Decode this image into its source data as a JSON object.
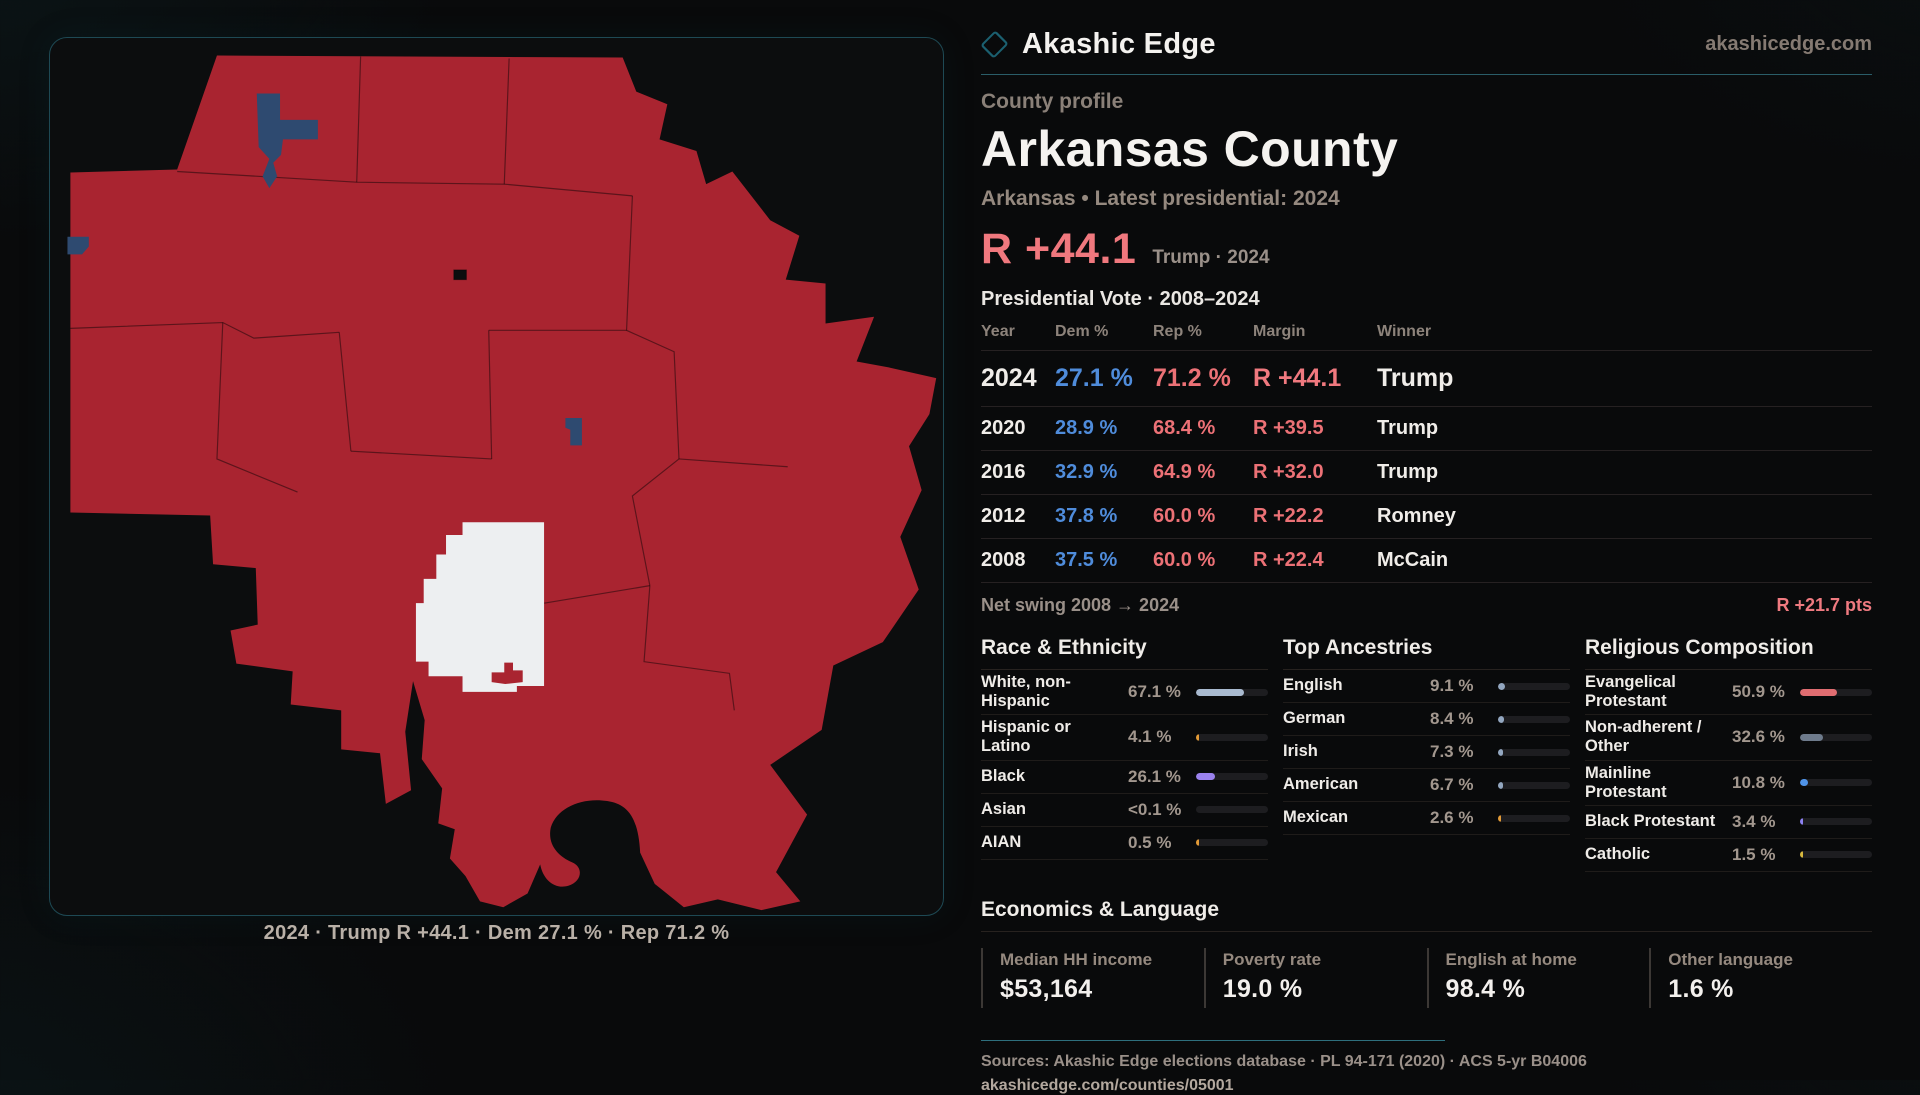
{
  "brand": {
    "name": "Akashic Edge",
    "domain": "akashicedge.com"
  },
  "profile": {
    "eyebrow": "County profile",
    "title": "Arkansas County",
    "subtitle": "Arkansas • Latest presidential: 2024",
    "margin_value": "R +44.1",
    "margin_caption": "Trump · 2024"
  },
  "map": {
    "caption": "2024 · Trump R +44.1 · Dem 27.1 % · Rep 71.2 %"
  },
  "vote_table": {
    "title": "Presidential Vote · 2008–2024",
    "columns": {
      "year": "Year",
      "dem": "Dem %",
      "rep": "Rep %",
      "margin": "Margin",
      "winner": "Winner"
    },
    "rows": [
      {
        "year": "2024",
        "dem": "27.1 %",
        "rep": "71.2 %",
        "margin": "R +44.1",
        "winner": "Trump"
      },
      {
        "year": "2020",
        "dem": "28.9 %",
        "rep": "68.4 %",
        "margin": "R +39.5",
        "winner": "Trump"
      },
      {
        "year": "2016",
        "dem": "32.9 %",
        "rep": "64.9 %",
        "margin": "R +32.0",
        "winner": "Trump"
      },
      {
        "year": "2012",
        "dem": "37.8 %",
        "rep": "60.0 %",
        "margin": "R +22.2",
        "winner": "Romney"
      },
      {
        "year": "2008",
        "dem": "37.5 %",
        "rep": "60.0 %",
        "margin": "R +22.4",
        "winner": "McCain"
      }
    ],
    "net_swing_label": "Net swing 2008 → 2024",
    "net_swing_value": "R +21.7 pts"
  },
  "race": {
    "title": "Race & Ethnicity",
    "rows": [
      {
        "label": "White, non-Hispanic",
        "value": "67.1 %",
        "pct": 67.1,
        "color": "#a9bad0"
      },
      {
        "label": "Hispanic or Latino",
        "value": "4.1 %",
        "pct": 4.1,
        "color": "#e29a36"
      },
      {
        "label": "Black",
        "value": "26.1 %",
        "pct": 26.1,
        "color": "#9b82ee"
      },
      {
        "label": "Asian",
        "value": "<0.1 %",
        "pct": 0,
        "color": "#a9bad0"
      },
      {
        "label": "AIAN",
        "value": "0.5 %",
        "pct": 0.5,
        "color": "#e29a36"
      }
    ]
  },
  "ancestries": {
    "title": "Top Ancestries",
    "rows": [
      {
        "label": "English",
        "value": "9.1 %",
        "pct": 9.1,
        "color": "#93a7c0"
      },
      {
        "label": "German",
        "value": "8.4 %",
        "pct": 8.4,
        "color": "#93a7c0"
      },
      {
        "label": "Irish",
        "value": "7.3 %",
        "pct": 7.3,
        "color": "#93a7c0"
      },
      {
        "label": "American",
        "value": "6.7 %",
        "pct": 6.7,
        "color": "#93a7c0"
      },
      {
        "label": "Mexican",
        "value": "2.6 %",
        "pct": 2.6,
        "color": "#e29a36"
      }
    ]
  },
  "religion": {
    "title": "Religious Composition",
    "rows": [
      {
        "label": "Evangelical Protestant",
        "value": "50.9 %",
        "pct": 50.9,
        "color": "#e06d71"
      },
      {
        "label": "Non-adherent / Other",
        "value": "32.6 %",
        "pct": 32.6,
        "color": "#6e7b8c"
      },
      {
        "label": "Mainline Protestant",
        "value": "10.8 %",
        "pct": 10.8,
        "color": "#4f93e8"
      },
      {
        "label": "Black Protestant",
        "value": "3.4 %",
        "pct": 3.4,
        "color": "#8d82f2"
      },
      {
        "label": "Catholic",
        "value": "1.5 %",
        "pct": 1.5,
        "color": "#d8b93e"
      }
    ]
  },
  "economics": {
    "title": "Economics & Language",
    "stats": [
      {
        "label": "Median HH income",
        "value": "$53,164"
      },
      {
        "label": "Poverty rate",
        "value": "19.0 %"
      },
      {
        "label": "English at home",
        "value": "98.4 %"
      },
      {
        "label": "Other language",
        "value": "1.6 %"
      }
    ]
  },
  "footer": {
    "sources": "Sources: Akashic Edge elections database · PL 94-171 (2020) · ACS 5-yr B04006",
    "link": "akashicedge.com/counties/05001"
  },
  "colors": {
    "map_red": "#a92430",
    "map_blue": "#2e4a70",
    "map_white": "#edeff1",
    "dem_blue": "#4f8cdb",
    "rep_red": "#ec7176",
    "accent_teal": "#2e6f7d"
  }
}
